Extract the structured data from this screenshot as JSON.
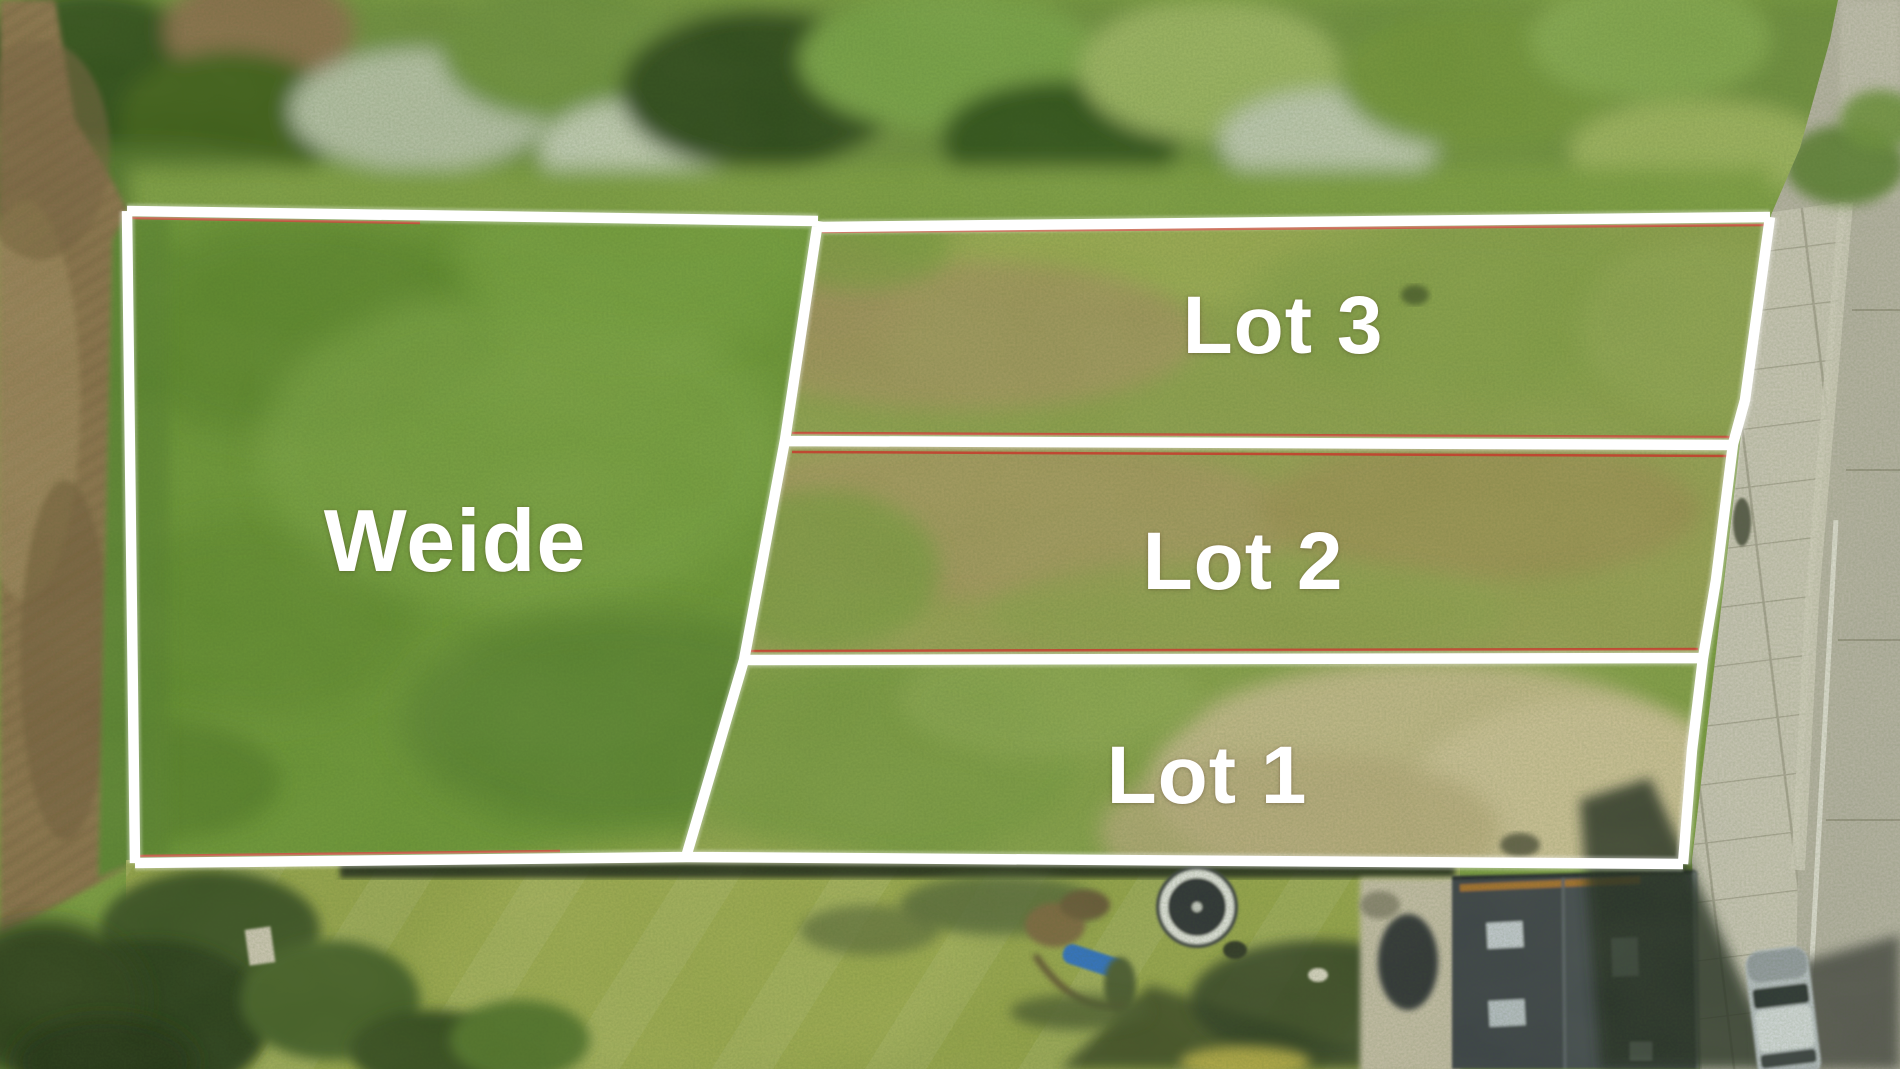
{
  "parcels": [
    {
      "id": "weide",
      "label": "Weide"
    },
    {
      "id": "lot-3",
      "label": "Lot 3"
    },
    {
      "id": "lot-2",
      "label": "Lot 2"
    },
    {
      "id": "lot-1",
      "label": "Lot 1"
    }
  ],
  "overlay": {
    "boundary_color": "#ffffff",
    "survey_line_color": "#c63b2c",
    "label_color": "#ffffff"
  },
  "scene": {
    "type": "aerial-drone-photo",
    "features": [
      "tree-line",
      "plowed-field",
      "pasture",
      "building-lots",
      "road",
      "sidewalk",
      "garden-lawn",
      "house-roof",
      "parked-car",
      "trampoline",
      "playground"
    ]
  }
}
